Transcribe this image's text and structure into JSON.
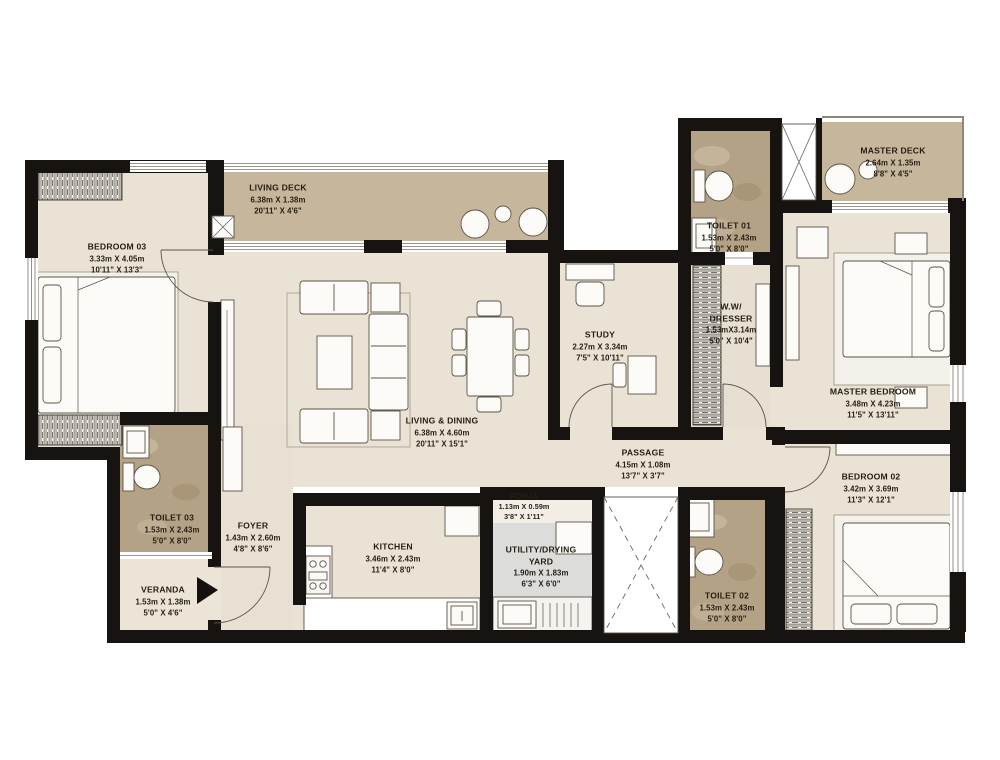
{
  "rooms": {
    "bedroom03": {
      "name": "BEDROOM 03",
      "dim_m": "3.33m X 4.05m",
      "dim_ft": "10'11\" X 13'3\""
    },
    "living_deck": {
      "name": "LIVING DECK",
      "dim_m": "6.38m X 1.38m",
      "dim_ft": "20'11\" X 4'6\""
    },
    "toilet01": {
      "name": "TOILET 01",
      "dim_m": "1.53m X 2.43m",
      "dim_ft": "5'0\" X 8'0\""
    },
    "master_deck": {
      "name": "MASTER DECK",
      "dim_m": "2.64m X 1.35m",
      "dim_ft": "8'8\" X 4'5\""
    },
    "study": {
      "name": "STUDY",
      "dim_m": "2.27m X 3.34m",
      "dim_ft": "7'5\" X 10'11\""
    },
    "ww_dresser": {
      "name": "W.W/ DRESSER",
      "dim_m": "1.53mX3.14m",
      "dim_ft": "5'0\" X 10'4\""
    },
    "master_bedroom": {
      "name": "MASTER BEDROOM",
      "dim_m": "3.48m X 4.23m",
      "dim_ft": "11'5\" X 13'11\""
    },
    "living_dining": {
      "name": "LIVING & DINING",
      "dim_m": "6.38m X 4.60m",
      "dim_ft": "20'11\" X 15'1\""
    },
    "passage": {
      "name": "PASSAGE",
      "dim_m": "4.15m X 1.08m",
      "dim_ft": "13'7\" X 3'7\""
    },
    "bedroom02": {
      "name": "BEDROOM 02",
      "dim_m": "3.42m X 3.69m",
      "dim_ft": "11'3\" X 12'1\""
    },
    "toilet03": {
      "name": "TOILET 03",
      "dim_m": "1.53m X 2.43m",
      "dim_ft": "5'0\" X 8'0\""
    },
    "foyer": {
      "name": "FOYER",
      "dim_m": "1.43m X 2.60m",
      "dim_ft": "4'8\" X 8'6\""
    },
    "kitchen": {
      "name": "KITCHEN",
      "dim_m": "3.46m X 2.43m",
      "dim_ft": "11'4\" X 8'0\""
    },
    "pooja": {
      "name": "POOJA",
      "dim_m": "1.13m X 0.59m",
      "dim_ft": "3'8\" X 1'11\""
    },
    "utility": {
      "name": "UTILITY/DRYING YARD",
      "dim_m": "1.90m X 1.83m",
      "dim_ft": "6'3\" X 6'0\""
    },
    "toilet02": {
      "name": "TOILET 02",
      "dim_m": "1.53m X 2.43m",
      "dim_ft": "5'0\" X 8'0\""
    },
    "veranda": {
      "name": "VERANDA",
      "dim_m": "1.53m X 1.38m",
      "dim_ft": "5'0\" X 4'6\""
    }
  },
  "colors": {
    "wall": "#171310",
    "floor": "#eae2d4",
    "deck": "#c6b69b",
    "toilet_floor": "#b4a286",
    "utility_floor": "#dcdcda",
    "text": "#241d12"
  }
}
